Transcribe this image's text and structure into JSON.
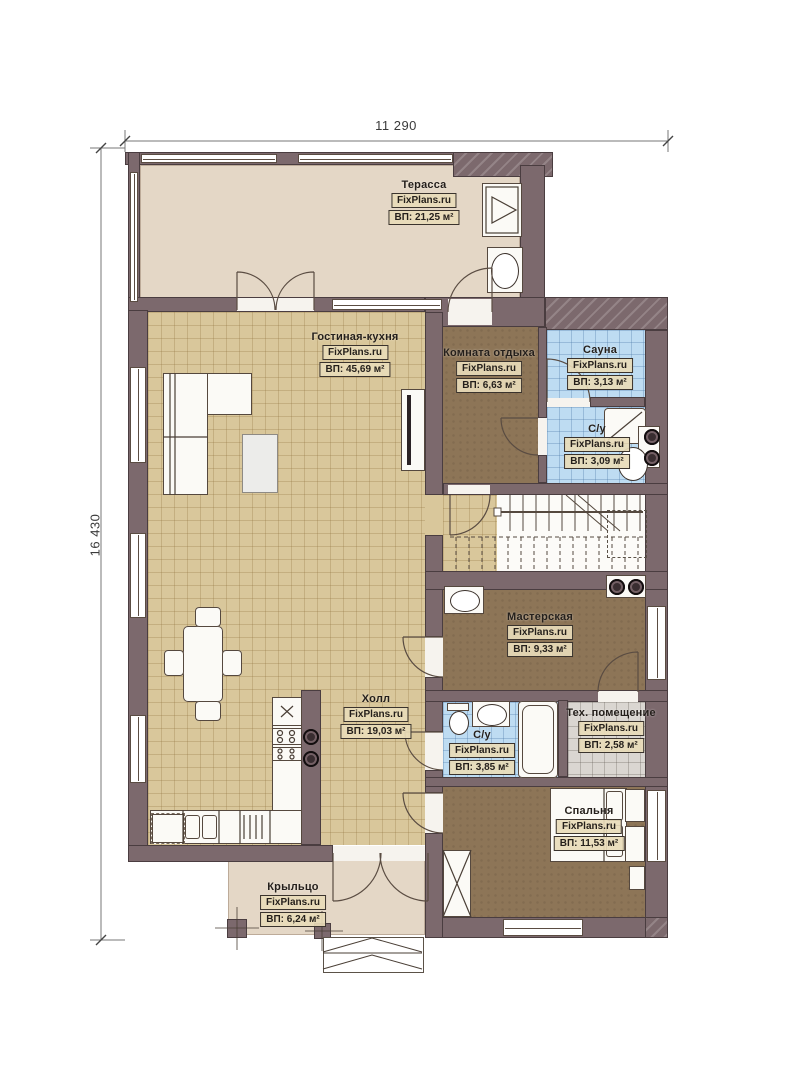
{
  "meta": {
    "brand": "FixPlans.ru",
    "drawing": "first-floor-plan"
  },
  "dimensions": {
    "width_label": "11 290",
    "height_label": "16 430"
  },
  "rooms": {
    "terrace": {
      "name": "Терасса",
      "area": "ВП: 21,25 м²"
    },
    "living": {
      "name": "Гостиная-кухня",
      "area": "ВП: 45,69 м²"
    },
    "rest": {
      "name": "Комната отдыха",
      "area": "ВП: 6,63 м²"
    },
    "sauna": {
      "name": "Сауна",
      "area": "ВП: 3,13 м²"
    },
    "wc1": {
      "name": "С/у",
      "area": "ВП: 3,09 м²"
    },
    "workshop": {
      "name": "Мастерская",
      "area": "ВП: 9,33 м²"
    },
    "hall": {
      "name": "Холл",
      "area": "ВП: 19,03 м²"
    },
    "wc2": {
      "name": "С/у",
      "area": "ВП: 3,85 м²"
    },
    "tech": {
      "name": "Тех. помещение",
      "area": "ВП: 2,58 м²"
    },
    "bedroom": {
      "name": "Спальня",
      "area": "ВП: 11,53 м²"
    },
    "porch": {
      "name": "Крыльцо",
      "area": "ВП: 6,24 м²"
    }
  },
  "colors": {
    "wall": "#7c696d",
    "terrace_floor": "#e4d7c6",
    "tile_floor": "#d9c79b",
    "wet_floor": "#bedcf2",
    "room_floor": "#8d7557",
    "tech_floor": "#dad6d1",
    "label_box": "#e8dbb9"
  }
}
